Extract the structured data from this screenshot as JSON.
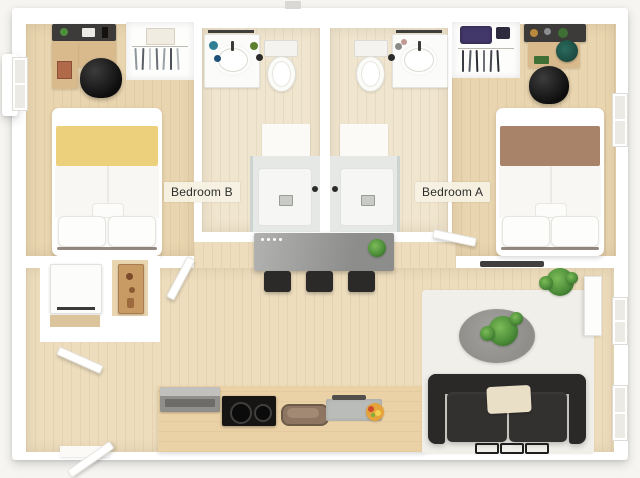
{
  "floorplan": {
    "type": "apartment-floor-plan-3d-top-view",
    "labels": [
      {
        "id": "bedroom-b",
        "text": "Bedroom B"
      },
      {
        "id": "bedroom-a",
        "text": "Bedroom A"
      }
    ],
    "rooms": [
      "bedroom-b",
      "bathroom-b",
      "bathroom-a",
      "bedroom-a",
      "kitchen-living-area",
      "entry-hall"
    ],
    "furniture": [
      "bed-with-yellow-runner",
      "bed-with-brown-runner",
      "desk",
      "desk-chair",
      "closet-hanging-clothes",
      "bathroom-vanity-sink",
      "toilet",
      "walk-in-shower",
      "bath-mat",
      "kitchen-island",
      "bar-stool",
      "cooktop",
      "microwave",
      "kitchen-sink",
      "fruit-bowl",
      "refrigerator",
      "pantry-shelves",
      "sofa",
      "throw-pillow",
      "round-rug",
      "area-rug",
      "potted-plant",
      "media-console",
      "front-door",
      "doormat",
      "window"
    ],
    "colors": {
      "bg": "#f6f5f2",
      "wall": "#ffffff",
      "floor_bedroom": "#e9d5af",
      "floor_living": "#edddbd",
      "floor_bath": "#f0e5ce",
      "floor_shower": "#e5e8e4",
      "bed_b_accent": "#ecd07c",
      "bed_a_accent": "#a8836a",
      "sofa": "#2a2928",
      "cushion": "#e9dec6",
      "island": "#9d9d9b",
      "counter_wood": "#ebd2a6",
      "rug_round": "#8f8e8a",
      "rug_area": "#f1efe9",
      "plant": "#4e8f3a",
      "chair": "#141414",
      "desk_shelf": "#3c3b39",
      "desk_wood": "#d8ba8d",
      "cooktop": "#161514",
      "label_text": "#2d2d2d"
    }
  }
}
